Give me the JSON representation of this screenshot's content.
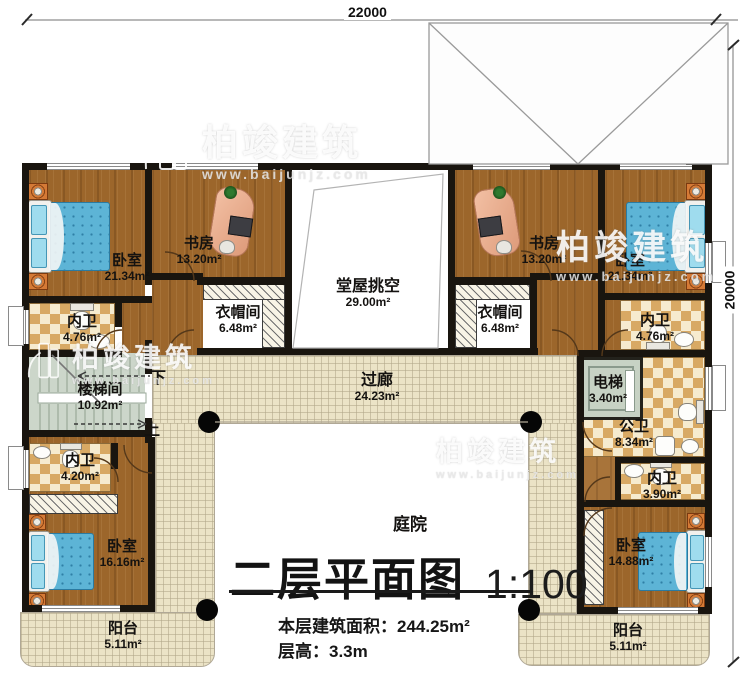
{
  "dimensions": {
    "top": "22000",
    "right": "20000"
  },
  "title": {
    "main": "二层平面图",
    "scale": "1:100",
    "area_label": "本层建筑面积：",
    "area_value": "244.25m²",
    "floor_height_label": "层高：",
    "floor_height_value": "3.3m"
  },
  "courtyard_label": "庭院",
  "stairs": {
    "down": "下",
    "up": "上"
  },
  "watermark": {
    "brand": "柏竣建筑",
    "url": "www.baijunjz.com",
    "logo": "building-logo"
  },
  "rooms": {
    "bedroom_tl": {
      "name": "卧室",
      "area": "21.34m²"
    },
    "study_l": {
      "name": "书房",
      "area": "13.20m²"
    },
    "hall_void": {
      "name": "堂屋挑空",
      "area": "29.00m²"
    },
    "study_r": {
      "name": "书房",
      "area": "13.20m²"
    },
    "bedroom_tr": {
      "name": "卧室",
      "area": "21.34m²"
    },
    "cloak_l": {
      "name": "衣帽间",
      "area": "6.48m²"
    },
    "cloak_r": {
      "name": "衣帽间",
      "area": "6.48m²"
    },
    "bath_tl": {
      "name": "内卫",
      "area": "4.76m²"
    },
    "bath_tr": {
      "name": "内卫",
      "area": "4.76m²"
    },
    "stairwell": {
      "name": "楼梯间",
      "area": "10.92m²"
    },
    "corridor": {
      "name": "过廊",
      "area": "24.23m²"
    },
    "elevator": {
      "name": "电梯",
      "area": "3.40m²"
    },
    "public_bath": {
      "name": "公卫",
      "area": "8.34m²"
    },
    "bath_ml": {
      "name": "内卫",
      "area": "4.20m²"
    },
    "bath_mr": {
      "name": "内卫",
      "area": "3.90m²"
    },
    "bedroom_bl": {
      "name": "卧室",
      "area": "16.16m²"
    },
    "bedroom_br": {
      "name": "卧室",
      "area": "14.88m²"
    },
    "balcony_l": {
      "name": "阳台",
      "area": "5.11m²"
    },
    "balcony_r": {
      "name": "阳台",
      "area": "5.11m²"
    }
  },
  "colors": {
    "wall": "#19150f",
    "wood_floor": "#9c662b",
    "tile_floor": "#ebe3c6",
    "checker_dark": "#d8a964",
    "checker_light": "#f6ebcf",
    "mattress_blue": "#5db4d6",
    "stair_floor": "#ccd6ca",
    "elevator_cab": "#c7d2c4",
    "watermark": "#ffffff"
  }
}
